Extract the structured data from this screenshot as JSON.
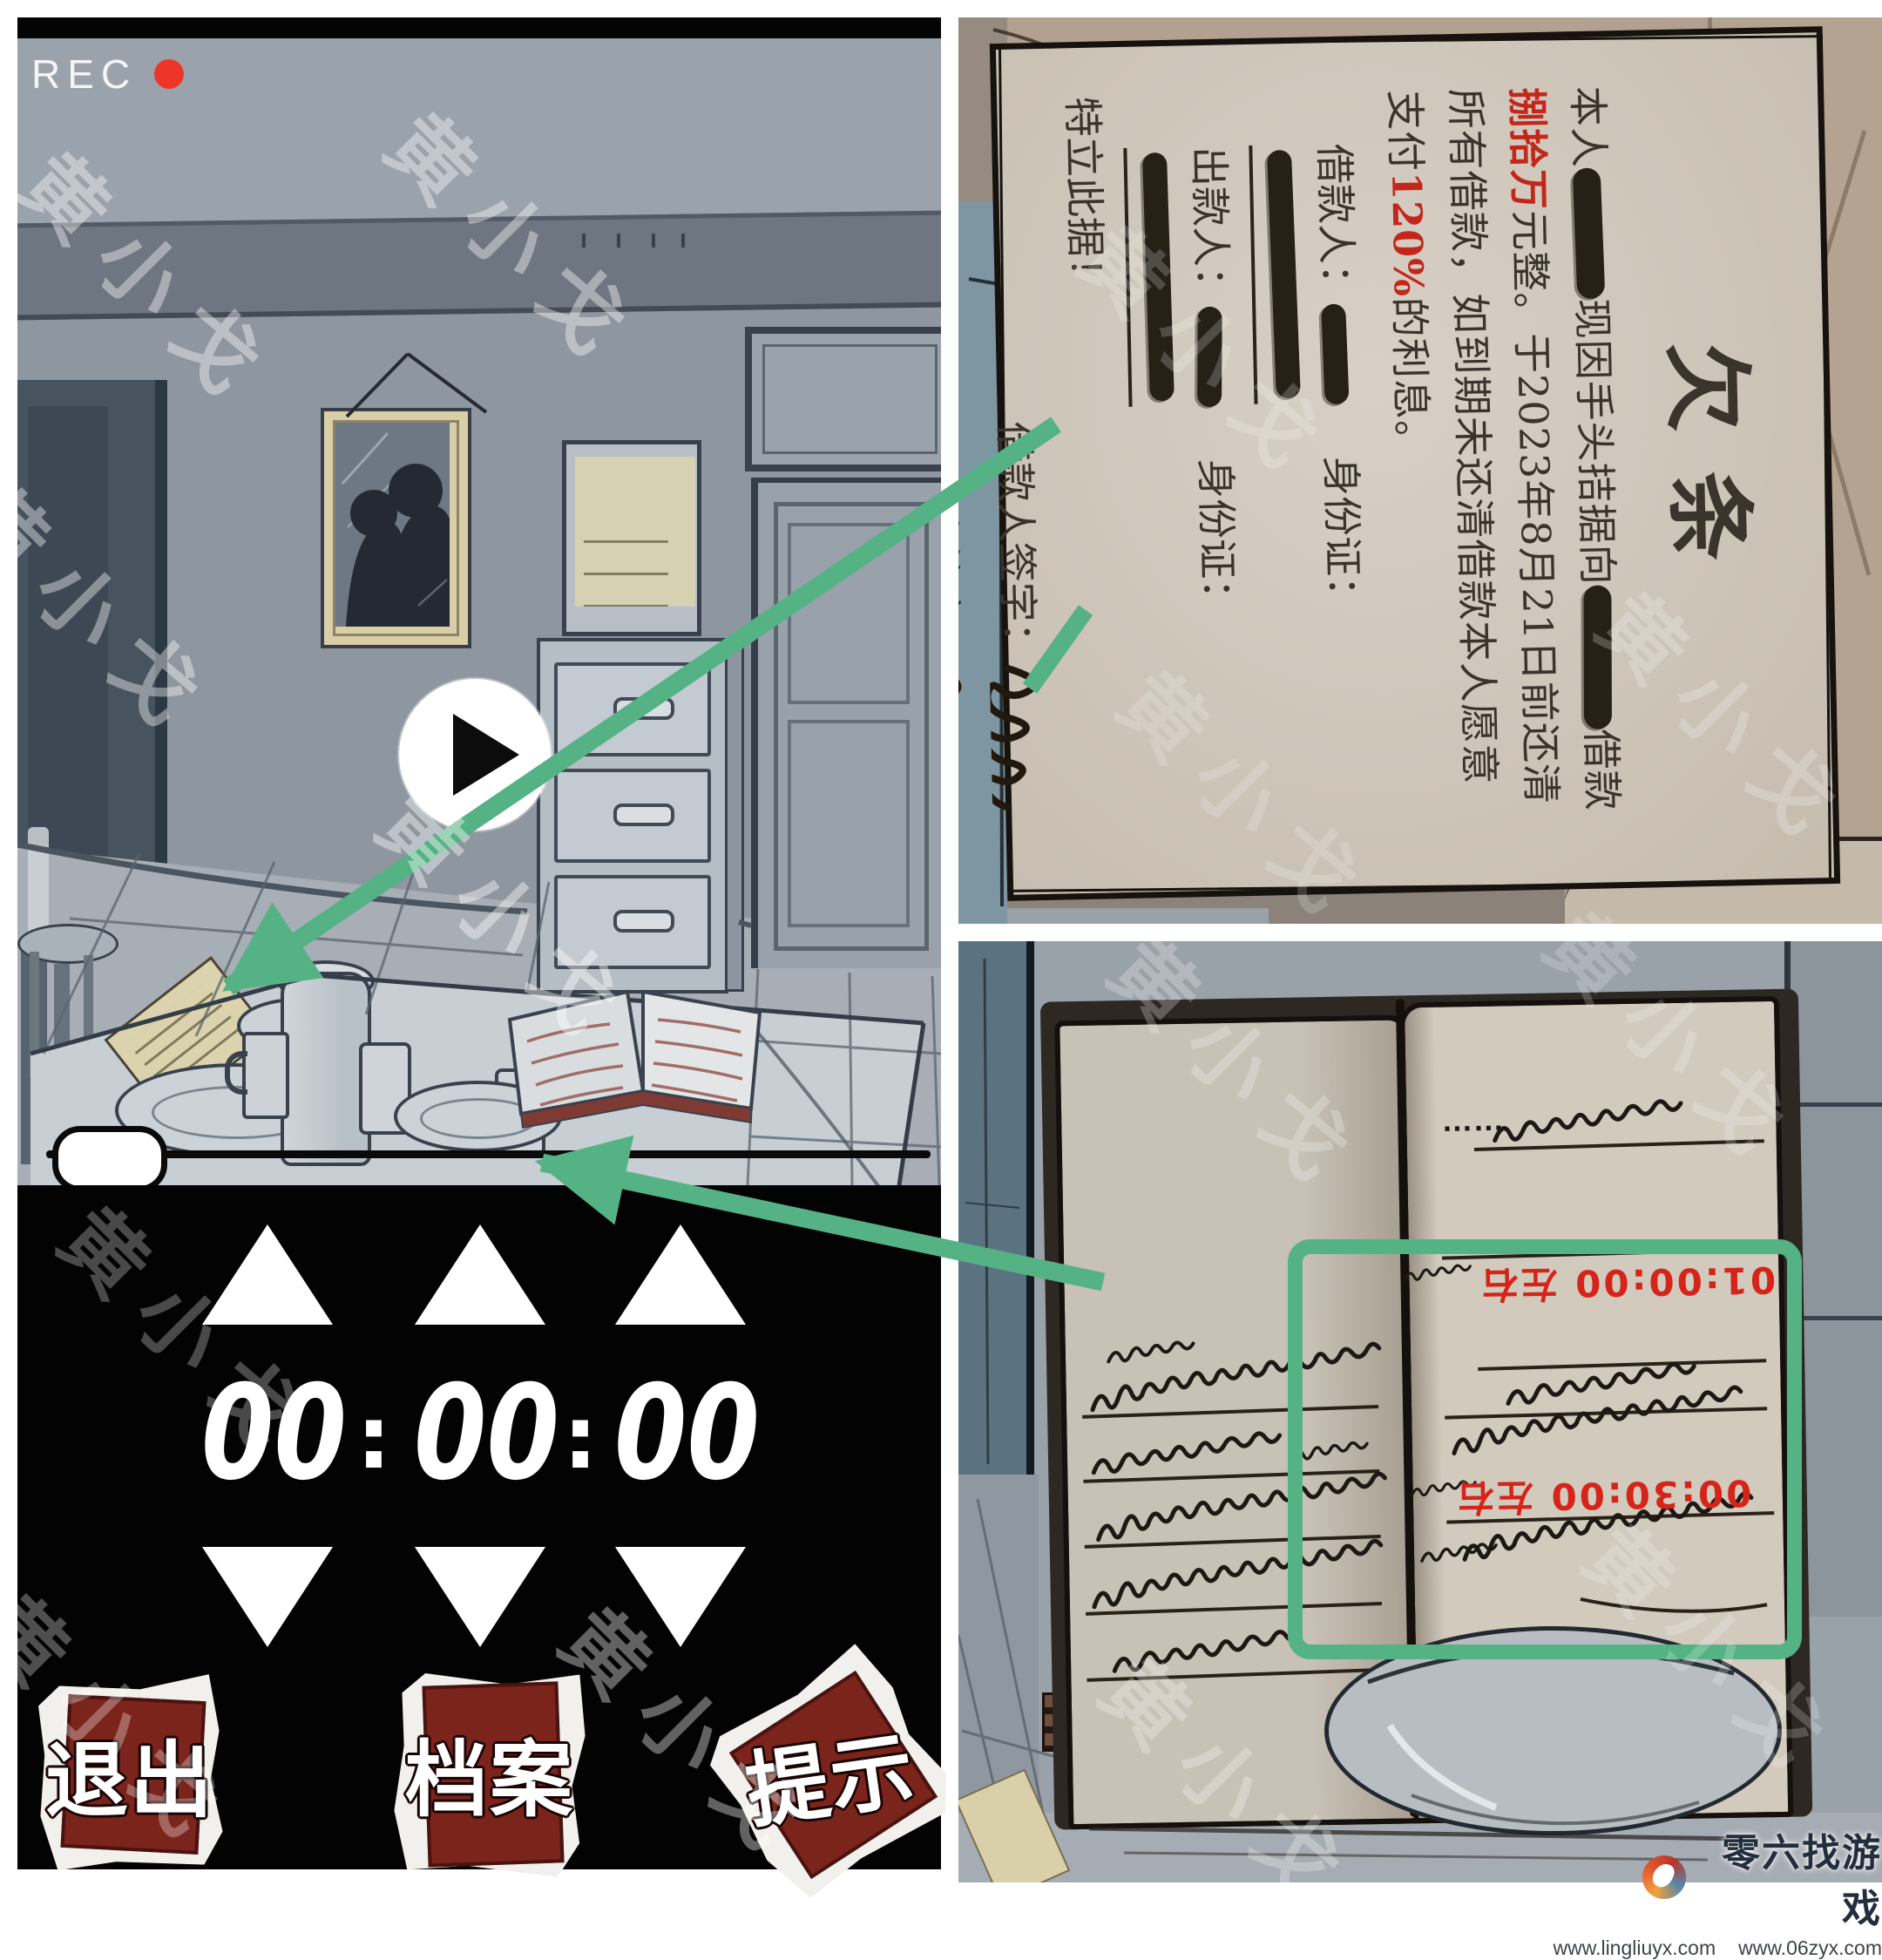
{
  "colors": {
    "highlight_green": "#55b285",
    "stamp_red": "#7b241c",
    "accent_red": "#c3271b",
    "rec_red": "#ee352a"
  },
  "watermark": {
    "text": "黄小戈"
  },
  "camera": {
    "rec_label": "REC"
  },
  "player": {
    "progress_percent": 0
  },
  "timer": {
    "hours": "00",
    "minutes": "00",
    "seconds": "00",
    "separator": ":"
  },
  "menu": {
    "exit_label": "退出",
    "archive_label": "档案",
    "hint_label": "提示"
  },
  "iou": {
    "title": "欠条",
    "p_1": "本人",
    "p_2": "现因手头拮据向",
    "p_3": "借款",
    "amount": "捌拾万",
    "p_4": "元整。于2023年8月21日前还清所有借款，如到期未还清借款本人愿意支付",
    "interest": "120%",
    "p_5": "的利息。",
    "borrower_label": "借款人：",
    "lender_label": "出款人：",
    "id_label": "身份证：",
    "declaration": "特立此据！",
    "borrower_sign_label": "借款人签字：",
    "lender_sign_label": "出借人签字：",
    "date": "2023年6月22日"
  },
  "notebook": {
    "ellipsis": "……",
    "time_note_1": "01:00:00 左右",
    "time_note_2": "00:30:00 左右"
  },
  "branding": {
    "site_name": "零六找游戏",
    "url_1": "www.lingliuyx.com",
    "url_2": "www.06zyx.com"
  }
}
